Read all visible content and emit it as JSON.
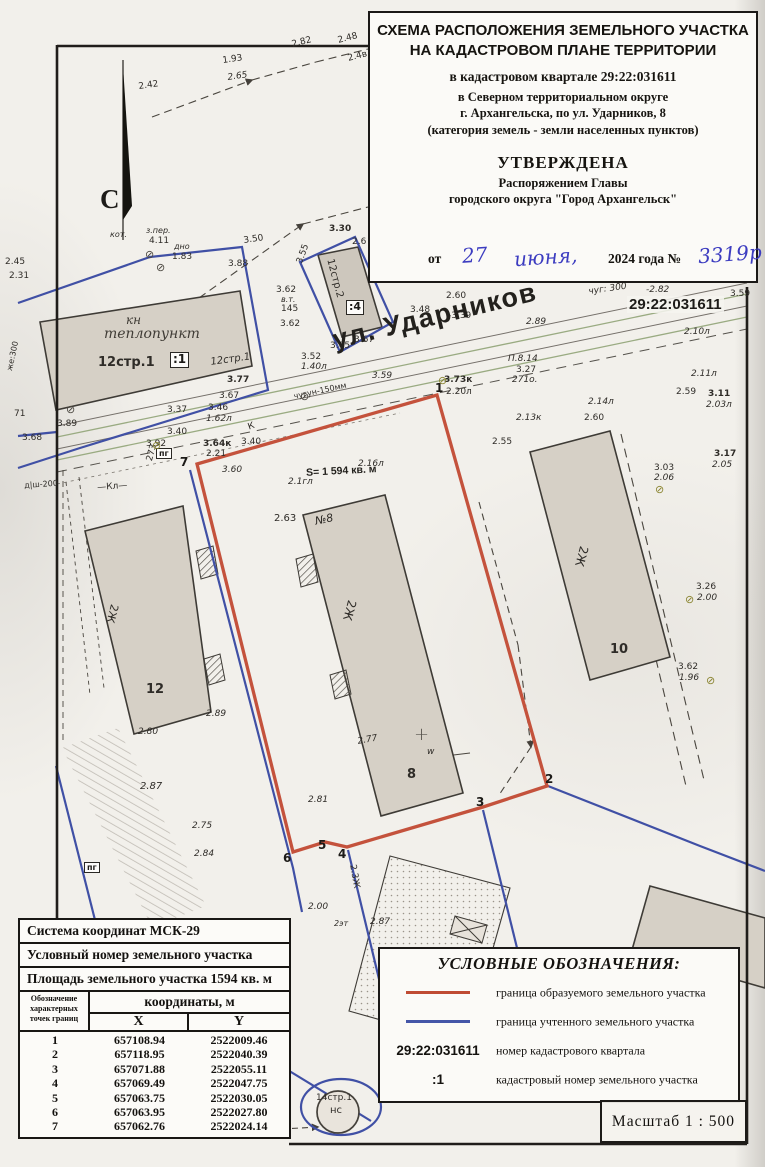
{
  "colors": {
    "boundary_red": "#c4523c",
    "parcel_blue": "#4050a5",
    "handwriting_blue": "#3c3cc0"
  },
  "doc": {
    "title_line1": "СХЕМА РАСПОЛОЖЕНИЯ ЗЕМЕЛЬНОГО УЧАСТКА",
    "title_line2": "НА КАДАСТРОВОМ ПЛАНЕ ТЕРРИТОРИИ",
    "subtitle_quarter": "в кадастровом квартале 29:22:031611",
    "subtitle_district": "в Северном территориальном округе",
    "subtitle_address": "г. Архангельска, по ул. Ударников, 8",
    "subtitle_category": "(категория земель - земли населенных пунктов)",
    "approved_title": "УТВЕРЖДЕНА",
    "approved_by1": "Распоряжением Главы",
    "approved_by2": "городского округа \"Город Архангельск\"",
    "date_prefix": "от",
    "date_day": "27",
    "date_month": "июня,",
    "date_suffix": "2024 года №",
    "date_number": "3319р"
  },
  "map": {
    "north_label": "С",
    "street_name": "ул. Ударников",
    "area_label": "S= 1 594 кв. м",
    "quarter_number": "29:22:031611",
    "labels": [
      {
        "t": "1.93",
        "x": 222,
        "y": 57,
        "r": -8
      },
      {
        "t": "2.65",
        "x": 227,
        "y": 74,
        "r": -8,
        "i": 1
      },
      {
        "t": "2.42",
        "x": 138,
        "y": 83,
        "r": -8
      },
      {
        "t": "2.82",
        "x": 291,
        "y": 41,
        "r": -14
      },
      {
        "t": "2.48",
        "x": 337,
        "y": 37,
        "r": -14
      },
      {
        "t": "2.4в",
        "x": 347,
        "y": 55,
        "r": -14
      },
      {
        "t": "кот.",
        "x": 110,
        "y": 231,
        "i": 1,
        "s": 8
      },
      {
        "t": "з.пер.",
        "x": 146,
        "y": 227,
        "i": 1,
        "s": 8
      },
      {
        "t": "4.11",
        "x": 149,
        "y": 237
      },
      {
        "t": "дно",
        "x": 174,
        "y": 243,
        "i": 1,
        "s": 8
      },
      {
        "t": "1.83",
        "x": 172,
        "y": 253
      },
      {
        "t": "3.50",
        "x": 243,
        "y": 237,
        "r": -8
      },
      {
        "t": "3.88",
        "x": 228,
        "y": 260
      },
      {
        "t": "3.30",
        "x": 329,
        "y": 225,
        "b": 1
      },
      {
        "t": "2.6",
        "x": 352,
        "y": 238
      },
      {
        "t": "2.45",
        "x": 5,
        "y": 258
      },
      {
        "t": "2.31",
        "x": 9,
        "y": 272
      },
      {
        "t": "же:300",
        "x": 6,
        "y": 370,
        "r": -78,
        "s": 8
      },
      {
        "t": "71",
        "x": 14,
        "y": 410
      },
      {
        "t": "3.68",
        "x": 22,
        "y": 434
      },
      {
        "t": "3.89",
        "x": 57,
        "y": 420
      },
      {
        "t": "д|ш-200",
        "x": 24,
        "y": 482,
        "r": -4,
        "s": 8
      },
      {
        "t": "—Кл—",
        "x": 97,
        "y": 484,
        "r": -4
      },
      {
        "t": "3.92",
        "x": 146,
        "y": 440
      },
      {
        "t": "3.37",
        "x": 167,
        "y": 406
      },
      {
        "t": "3.77",
        "x": 227,
        "y": 376,
        "b": 1
      },
      {
        "t": "3.67",
        "x": 219,
        "y": 392
      },
      {
        "t": "3.46",
        "x": 208,
        "y": 404
      },
      {
        "t": "1.62л",
        "x": 206,
        "y": 415,
        "i": 1
      },
      {
        "t": "3.40",
        "x": 167,
        "y": 428
      },
      {
        "t": "3.64к",
        "x": 203,
        "y": 440,
        "b": 1
      },
      {
        "t": "2.21",
        "x": 206,
        "y": 450
      },
      {
        "t": "К",
        "x": 247,
        "y": 424,
        "r": -20
      },
      {
        "t": "3.40",
        "x": 241,
        "y": 438
      },
      {
        "t": "273",
        "x": 146,
        "y": 460,
        "r": -75
      },
      {
        "t": "3.60",
        "x": 222,
        "y": 466,
        "i": 1
      },
      {
        "t": "2.1гл",
        "x": 288,
        "y": 478,
        "i": 1
      },
      {
        "t": "2.16л",
        "x": 358,
        "y": 460,
        "i": 1
      },
      {
        "t": "2.63",
        "x": 274,
        "y": 514,
        "s": 10
      },
      {
        "t": "№8",
        "x": 314,
        "y": 516,
        "i": 1,
        "s": 11,
        "r": -12
      },
      {
        "t": "2.77",
        "x": 357,
        "y": 738,
        "r": -10,
        "i": 1
      },
      {
        "t": "w",
        "x": 427,
        "y": 748,
        "i": 1
      },
      {
        "t": "2.81",
        "x": 308,
        "y": 796,
        "i": 1
      },
      {
        "t": "2.80",
        "x": 138,
        "y": 728,
        "i": 1
      },
      {
        "t": "2.89",
        "x": 206,
        "y": 710,
        "i": 1
      },
      {
        "t": "2.55",
        "x": 492,
        "y": 438
      },
      {
        "t": "2.13к",
        "x": 516,
        "y": 414,
        "i": 1
      },
      {
        "t": "2.60",
        "x": 584,
        "y": 414
      },
      {
        "t": "2.14л",
        "x": 588,
        "y": 398,
        "i": 1
      },
      {
        "t": "2.89",
        "x": 526,
        "y": 318,
        "i": 1
      },
      {
        "t": "чуг: 300",
        "x": 588,
        "y": 288,
        "r": -8,
        "i": 1
      },
      {
        "t": "-2.82",
        "x": 646,
        "y": 286,
        "i": 1
      },
      {
        "t": "3.59",
        "x": 730,
        "y": 290
      },
      {
        "t": "2.10л",
        "x": 684,
        "y": 328,
        "i": 1
      },
      {
        "t": "2.11л",
        "x": 691,
        "y": 370,
        "i": 1
      },
      {
        "t": "2.59",
        "x": 676,
        "y": 388
      },
      {
        "t": "3.11",
        "x": 708,
        "y": 390,
        "b": 1
      },
      {
        "t": "2.03л",
        "x": 706,
        "y": 401,
        "i": 1
      },
      {
        "t": "3.17",
        "x": 714,
        "y": 450,
        "b": 1
      },
      {
        "t": "2.05",
        "x": 712,
        "y": 461,
        "i": 1
      },
      {
        "t": "3.03",
        "x": 654,
        "y": 464
      },
      {
        "t": "2.06",
        "x": 654,
        "y": 474,
        "i": 1
      },
      {
        "t": "3.26",
        "x": 696,
        "y": 583
      },
      {
        "t": "2.00",
        "x": 697,
        "y": 594,
        "i": 1
      },
      {
        "t": "3.62",
        "x": 678,
        "y": 663
      },
      {
        "t": "1.96",
        "x": 679,
        "y": 674,
        "i": 1
      },
      {
        "t": "П.8.14",
        "x": 508,
        "y": 355,
        "i": 1
      },
      {
        "t": "3.27",
        "x": 516,
        "y": 366
      },
      {
        "t": "271о.",
        "x": 512,
        "y": 376,
        "i": 1
      },
      {
        "t": "3.73к",
        "x": 444,
        "y": 376,
        "b": 1
      },
      {
        "t": "2.20л",
        "x": 446,
        "y": 388
      },
      {
        "t": "3.59",
        "x": 372,
        "y": 372,
        "i": 1
      },
      {
        "t": "3.52",
        "x": 301,
        "y": 353
      },
      {
        "t": "1.40л",
        "x": 301,
        "y": 363,
        "i": 1
      },
      {
        "t": "чугун-150мм",
        "x": 293,
        "y": 393,
        "r": -12,
        "s": 8
      },
      {
        "t": "3.65",
        "x": 330,
        "y": 342
      },
      {
        "t": "3.67",
        "x": 354,
        "y": 336
      },
      {
        "t": "3.48",
        "x": 410,
        "y": 306
      },
      {
        "t": "-3.39",
        "x": 448,
        "y": 312
      },
      {
        "t": "2.60",
        "x": 446,
        "y": 292
      },
      {
        "t": "3.62",
        "x": 276,
        "y": 286
      },
      {
        "t": "в.т.",
        "x": 281,
        "y": 296,
        "i": 1,
        "s": 8
      },
      {
        "t": "145",
        "x": 281,
        "y": 305
      },
      {
        "t": "3.62",
        "x": 280,
        "y": 320
      },
      {
        "t": "3.55",
        "x": 296,
        "y": 262,
        "r": -70
      },
      {
        "t": "2.87",
        "x": 140,
        "y": 782,
        "i": 1,
        "s": 10
      },
      {
        "t": "2.75",
        "x": 192,
        "y": 822,
        "i": 1
      },
      {
        "t": "2.84",
        "x": 194,
        "y": 850,
        "i": 1
      },
      {
        "t": "2.00",
        "x": 308,
        "y": 903,
        "i": 1
      },
      {
        "t": "2эт",
        "x": 334,
        "y": 920,
        "i": 1,
        "s": 8
      },
      {
        "t": "2.87",
        "x": 370,
        "y": 918,
        "i": 1
      },
      {
        "t": "2.3Ж",
        "x": 356,
        "y": 864,
        "r": 80
      },
      {
        "t": "14стр.1",
        "x": 316,
        "y": 1094,
        "s": 9
      },
      {
        "t": "нс",
        "x": 330,
        "y": 1106,
        "s": 10
      },
      {
        "t": "12стр.1",
        "x": 98,
        "y": 356,
        "b": 1,
        "s": 13
      },
      {
        "t": "12стр.1",
        "x": 210,
        "y": 358,
        "i": 1,
        "s": 10,
        "r": -8
      },
      {
        "t": "кн",
        "x": 126,
        "y": 314,
        "hw": 1,
        "s": 12
      },
      {
        "t": "теплопункт",
        "x": 104,
        "y": 327,
        "hw": 1,
        "s": 14
      },
      {
        "t": "12стр.2",
        "x": 334,
        "y": 258,
        "r": 75,
        "s": 10
      },
      {
        "t": "2Ж",
        "x": 120,
        "y": 606,
        "r": 105,
        "s": 11
      },
      {
        "t": "2Ж",
        "x": 358,
        "y": 602,
        "r": 105,
        "s": 12
      },
      {
        "t": "2Ж",
        "x": 590,
        "y": 548,
        "r": 105,
        "s": 12
      },
      {
        "t": "12",
        "x": 146,
        "y": 683,
        "b": 1,
        "s": 13
      },
      {
        "t": "8",
        "x": 407,
        "y": 768,
        "b": 1,
        "s": 13
      },
      {
        "t": "10",
        "x": 610,
        "y": 643,
        "b": 1,
        "s": 13
      }
    ],
    "vertex_labels": [
      {
        "n": "1",
        "x": 435,
        "y": 382
      },
      {
        "n": "2",
        "x": 545,
        "y": 773
      },
      {
        "n": "3",
        "x": 476,
        "y": 796
      },
      {
        "n": "4",
        "x": 338,
        "y": 848
      },
      {
        "n": "5",
        "x": 318,
        "y": 839
      },
      {
        "n": "6",
        "x": 283,
        "y": 852
      },
      {
        "n": "7",
        "x": 180,
        "y": 456
      }
    ],
    "boxed_labels": [
      {
        "t": ":1",
        "x": 170,
        "y": 352,
        "s": 12
      },
      {
        "t": ":4",
        "x": 346,
        "y": 300,
        "s": 11
      },
      {
        "t": "пг",
        "x": 156,
        "y": 448,
        "s": 8
      },
      {
        "t": "пг",
        "x": 84,
        "y": 862,
        "s": 8
      }
    ],
    "symbols": [
      {
        "k": "survey-point",
        "x": 152,
        "y": 440,
        "c": "#8a8430"
      },
      {
        "k": "survey-point",
        "x": 655,
        "y": 484,
        "c": "#8a8430"
      },
      {
        "k": "survey-point",
        "x": 685,
        "y": 594,
        "c": "#8a8430"
      },
      {
        "k": "survey-point",
        "x": 706,
        "y": 675,
        "c": "#8a8430"
      },
      {
        "k": "survey-point",
        "x": 438,
        "y": 375,
        "c": "#8a8430"
      },
      {
        "k": "survey-point",
        "x": 66,
        "y": 404,
        "c": "#4a463f"
      },
      {
        "k": "survey-point",
        "x": 300,
        "y": 391,
        "c": "#4a463f"
      },
      {
        "k": "survey-point",
        "x": 145,
        "y": 249,
        "c": "#4a463f"
      },
      {
        "k": "survey-point",
        "x": 156,
        "y": 262,
        "c": "#4a463f"
      },
      {
        "k": "cross",
        "x": 414,
        "y": 726,
        "c": "#55514b"
      }
    ]
  },
  "table": {
    "row1": "Система координат МСК-29",
    "row2": "Условный номер земельного участка",
    "row3": "Площадь земельного участка 1594 кв. м",
    "col_points": "Обозначение характерных точек границ",
    "col_coords": "координаты, м",
    "col_x": "X",
    "col_y": "Y",
    "rows": [
      [
        "1",
        "657108.94",
        "2522009.46"
      ],
      [
        "2",
        "657118.95",
        "2522040.39"
      ],
      [
        "3",
        "657071.88",
        "2522055.11"
      ],
      [
        "4",
        "657069.49",
        "2522047.75"
      ],
      [
        "5",
        "657063.75",
        "2522030.05"
      ],
      [
        "6",
        "657063.95",
        "2522027.80"
      ],
      [
        "7",
        "657062.76",
        "2522024.14"
      ]
    ]
  },
  "legend": {
    "title": "УСЛОВНЫЕ ОБОЗНАЧЕНИЯ:",
    "items": [
      {
        "type": "line",
        "color": "#bf4b33",
        "label": "граница образуемого земельного участка"
      },
      {
        "type": "line",
        "color": "#4456a8",
        "label": "граница учтенного земельного участка"
      },
      {
        "type": "text",
        "symbol": "29:22:031611",
        "label": "номер кадастрового квартала"
      },
      {
        "type": "text",
        "symbol": ":1",
        "label": "кадастровый номер земельного участка"
      }
    ]
  },
  "scale": {
    "label": "Масштаб 1 : 500"
  }
}
